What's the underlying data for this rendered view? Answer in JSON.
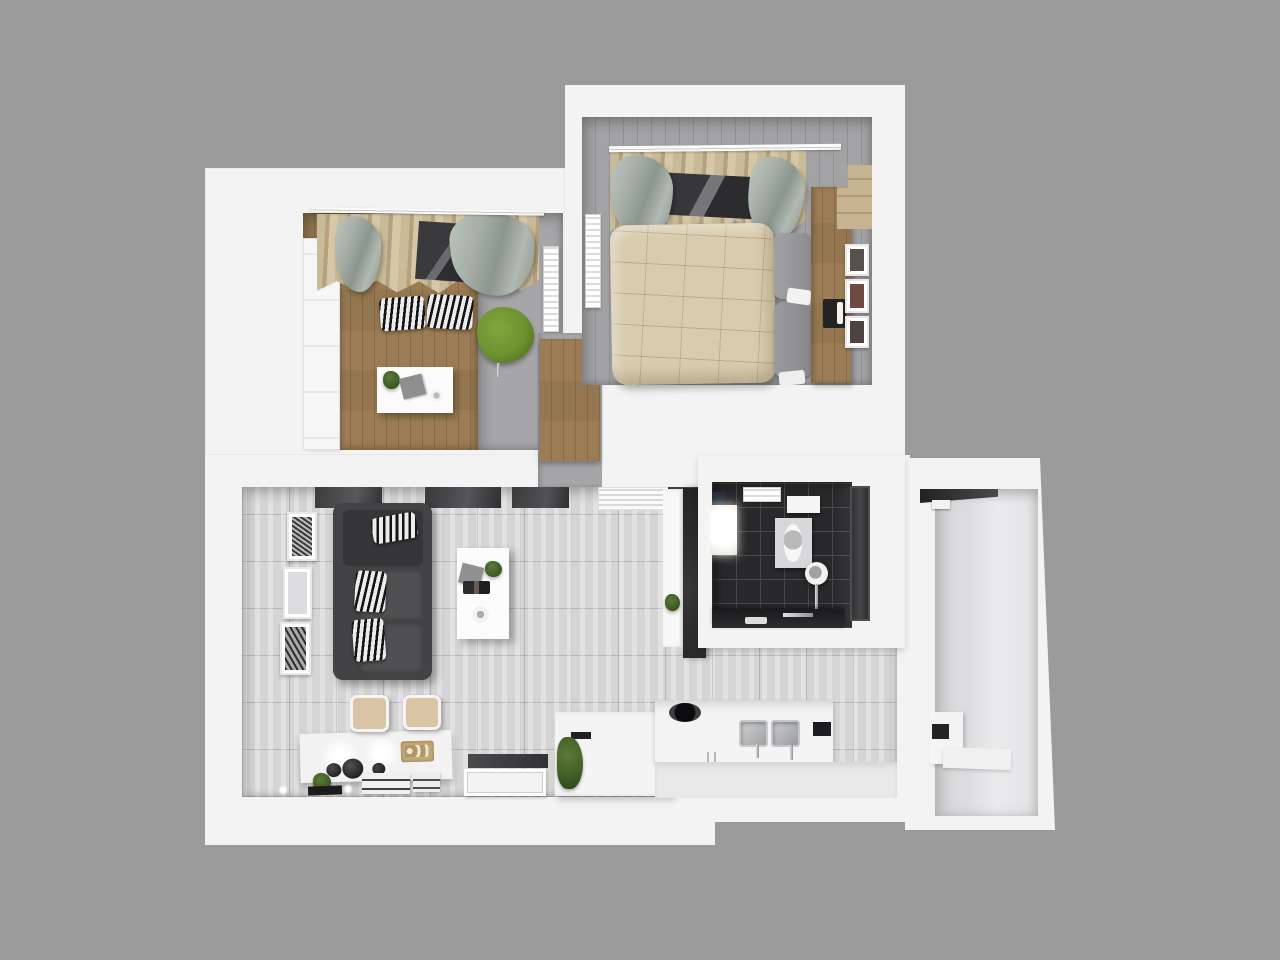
{
  "scene": {
    "type": "3d-architectural-floorplan-render",
    "view": "top-down dollhouse view of a one-bedroom apartment",
    "background_color": "#9b9b9b",
    "wall_color": "#f3f3f4"
  },
  "colors": {
    "bg": "#9b9b9b",
    "wall": "#f3f3f4",
    "tile": "#d5d5d5",
    "dark-tile": "#29292b",
    "wood": "#c7b292",
    "gray-floor": "#a6a6a8",
    "bed-floor": "#a3a2a4",
    "duvet": "#d9ccae",
    "sage": "#a7b1aa",
    "tan": "#cabb98",
    "sofa": "#434345",
    "green": "#6d9130",
    "beige": "#d9c4a6",
    "dark-cab": "#2e2c2b",
    "dark-door": "#3b3b3d",
    "chrome": "#b9bbbd"
  },
  "rooms": [
    {
      "id": "office",
      "position": "top-left",
      "furniture": [
        "white paneled door",
        "curtain rod with tan and sage curtains",
        "dark window",
        "two zebra floor cushions",
        "green chair",
        "white desk with plant, papers and cup",
        "wall radiator",
        "wood plank floor with gray walkway"
      ]
    },
    {
      "id": "bedroom",
      "position": "top-right",
      "furniture": [
        "curtain rod with tan and sage curtains",
        "dark window",
        "double bed with beige duvet",
        "two gray pillows",
        "wood headboard and stepped shelf",
        "dark tray with candles",
        "three wall frames",
        "wall radiator",
        "gray plank floor"
      ]
    },
    {
      "id": "hallway",
      "position": "center between office and living room",
      "furniture": [
        "wood wardrobe",
        "gray floor"
      ]
    },
    {
      "id": "living-dining-room",
      "position": "bottom-left",
      "furniture": [
        "charcoal sofa with three zebra pillows",
        "white coffee table with plant, gray board, magazines and plate",
        "three wall art frames",
        "dark interior windows along top wall",
        "white vented panel",
        "white shelf with plant",
        "dark tall wardrobe",
        "dining console with two spotlights, bowls and gold tray",
        "two beige chairs",
        "white floor mats with prints",
        "plant and black tray",
        "dark entry mat and white tray",
        "light gray tile floor"
      ]
    },
    {
      "id": "kitchen",
      "position": "bottom-center",
      "furniture": [
        "white appliance unit with gray lid",
        "plant",
        "black hob pot",
        "double stainless sink with faucets",
        "white counters with handles",
        "dark counter item"
      ]
    },
    {
      "id": "bathroom",
      "position": "center-right",
      "furniture": [
        "dark mosaic tile floor",
        "towel radiator",
        "white wall shelf",
        "dark wall box",
        "glowing shower panel",
        "toilet",
        "round vessel sink with tall chrome faucet",
        "dark vanity counter with chrome faucet and soap dish",
        "dark gray door"
      ]
    },
    {
      "id": "balcony",
      "position": "right-wing",
      "furniture": [
        "dark window header with light fixture",
        "white counter with dark appliance front",
        "white slab",
        "bare light floor"
      ]
    }
  ]
}
